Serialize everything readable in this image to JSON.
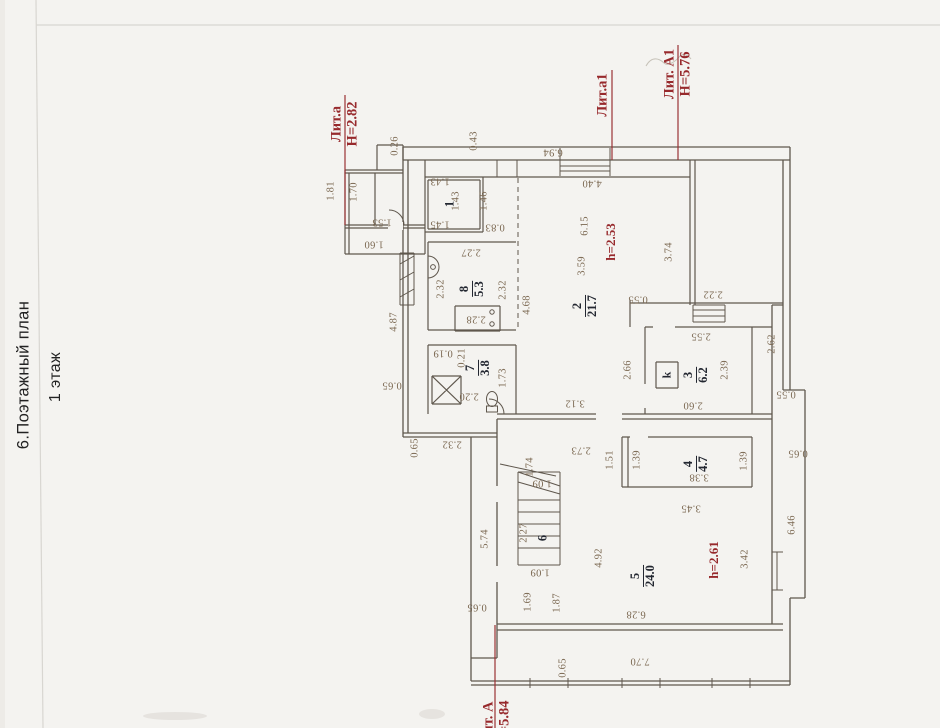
{
  "header": {
    "title": "6.Поэтажный план",
    "floor": "1 этаж"
  },
  "plan": {
    "colors": {
      "wall": "#5f574d",
      "dim": "#7a6750",
      "room": "#232731",
      "red": "#97292c"
    },
    "lit_labels": [
      {
        "lines": [
          "Лит.а",
          "Н=2.82"
        ],
        "x": 345,
        "y": 124
      },
      {
        "lines": [
          "Лит.а1"
        ],
        "x": 603,
        "y": 95
      },
      {
        "lines": [
          "Лит. А1",
          "Н=5.76"
        ],
        "x": 678,
        "y": 74
      },
      {
        "lines": [
          "Лит. А",
          "Н=5.84"
        ],
        "x": 497,
        "y": 723
      }
    ],
    "height_labels": [
      {
        "t": "h=2.53",
        "x": 611,
        "y": 242
      },
      {
        "t": "h=2.61",
        "x": 714,
        "y": 560
      }
    ],
    "stove": {
      "label": "k",
      "x": 667,
      "y": 375
    },
    "rooms": [
      {
        "num": "1",
        "area": "",
        "x": 450,
        "y": 204
      },
      {
        "num": "8",
        "area": "5.3",
        "x": 472,
        "y": 289
      },
      {
        "num": "2",
        "area": "21.7",
        "x": 585,
        "y": 306
      },
      {
        "num": "7",
        "area": "3.8",
        "x": 478,
        "y": 368
      },
      {
        "num": "3",
        "area": "6.2",
        "x": 696,
        "y": 375
      },
      {
        "num": "4",
        "area": "4.7",
        "x": 696,
        "y": 464
      },
      {
        "num": "6",
        "area": "",
        "x": 543,
        "y": 538
      },
      {
        "num": "5",
        "area": "24.0",
        "x": 643,
        "y": 576
      }
    ],
    "dims": [
      {
        "t": "0.26",
        "x": 395,
        "y": 146,
        "o": "v"
      },
      {
        "t": "0.43",
        "x": 474,
        "y": 141,
        "o": "v"
      },
      {
        "t": "6.94",
        "x": 553,
        "y": 152,
        "o": "u"
      },
      {
        "t": "4.40",
        "x": 592,
        "y": 183,
        "o": "u"
      },
      {
        "t": "1.81",
        "x": 331,
        "y": 191,
        "o": "v"
      },
      {
        "t": "1.70",
        "x": 354,
        "y": 192,
        "o": "v"
      },
      {
        "t": "1.53",
        "x": 382,
        "y": 222,
        "o": "u"
      },
      {
        "t": "1.60",
        "x": 374,
        "y": 244,
        "o": "u"
      },
      {
        "t": "1.43",
        "x": 440,
        "y": 181,
        "o": "u"
      },
      {
        "t": "1.43",
        "x": 456,
        "y": 201,
        "o": "v"
      },
      {
        "t": "1.45",
        "x": 440,
        "y": 224,
        "o": "u"
      },
      {
        "t": "1.46",
        "x": 484,
        "y": 201,
        "o": "v"
      },
      {
        "t": "0.83",
        "x": 495,
        "y": 227,
        "o": "u"
      },
      {
        "t": "2.27",
        "x": 471,
        "y": 252,
        "o": "u"
      },
      {
        "t": "2.32",
        "x": 441,
        "y": 289,
        "o": "v"
      },
      {
        "t": "2.32",
        "x": 503,
        "y": 290,
        "o": "v"
      },
      {
        "t": "4.68",
        "x": 527,
        "y": 305,
        "o": "v"
      },
      {
        "t": "4.87",
        "x": 394,
        "y": 322,
        "o": "v"
      },
      {
        "t": "6.15",
        "x": 585,
        "y": 226,
        "o": "v"
      },
      {
        "t": "3.59",
        "x": 582,
        "y": 266,
        "o": "v"
      },
      {
        "t": "3.74",
        "x": 669,
        "y": 252,
        "o": "v"
      },
      {
        "t": "0.55",
        "x": 638,
        "y": 299,
        "o": "u"
      },
      {
        "t": "2.22",
        "x": 713,
        "y": 294,
        "o": "u"
      },
      {
        "t": "2.55",
        "x": 701,
        "y": 336,
        "o": "u"
      },
      {
        "t": "2.62",
        "x": 772,
        "y": 344,
        "o": "v"
      },
      {
        "t": "2.66",
        "x": 628,
        "y": 370,
        "o": "v"
      },
      {
        "t": "2.39",
        "x": 725,
        "y": 370,
        "o": "v"
      },
      {
        "t": "0.55",
        "x": 786,
        "y": 394,
        "o": "u"
      },
      {
        "t": "2.60",
        "x": 693,
        "y": 405,
        "o": "u"
      },
      {
        "t": "3.12",
        "x": 575,
        "y": 403,
        "o": "u"
      },
      {
        "t": "2.73",
        "x": 581,
        "y": 450,
        "o": "u"
      },
      {
        "t": "1.51",
        "x": 610,
        "y": 460,
        "o": "v"
      },
      {
        "t": "1.39",
        "x": 637,
        "y": 460,
        "o": "v"
      },
      {
        "t": "1.39",
        "x": 744,
        "y": 461,
        "o": "v"
      },
      {
        "t": "3.38",
        "x": 699,
        "y": 477,
        "o": "u"
      },
      {
        "t": "0.65",
        "x": 798,
        "y": 453,
        "o": "u"
      },
      {
        "t": "6.46",
        "x": 792,
        "y": 525,
        "o": "v"
      },
      {
        "t": "3.42",
        "x": 745,
        "y": 559,
        "o": "v"
      },
      {
        "t": "3.45",
        "x": 691,
        "y": 508,
        "o": "u"
      },
      {
        "t": "0.19",
        "x": 443,
        "y": 353,
        "o": "u"
      },
      {
        "t": "0.21",
        "x": 462,
        "y": 358,
        "o": "v"
      },
      {
        "t": "1.73",
        "x": 503,
        "y": 378,
        "o": "v"
      },
      {
        "t": "2.20",
        "x": 469,
        "y": 396,
        "o": "u"
      },
      {
        "t": "2.28",
        "x": 476,
        "y": 319,
        "o": "u"
      },
      {
        "t": "0.65",
        "x": 392,
        "y": 385,
        "o": "u"
      },
      {
        "t": "0.65",
        "x": 415,
        "y": 448,
        "o": "v"
      },
      {
        "t": "2.32",
        "x": 452,
        "y": 444,
        "o": "u"
      },
      {
        "t": "1.74",
        "x": 530,
        "y": 467,
        "o": "v"
      },
      {
        "t": "1.09",
        "x": 542,
        "y": 483,
        "o": "u"
      },
      {
        "t": "2.27",
        "x": 524,
        "y": 533,
        "o": "v"
      },
      {
        "t": "1.09",
        "x": 540,
        "y": 572,
        "o": "u"
      },
      {
        "t": "5.74",
        "x": 485,
        "y": 539,
        "o": "v"
      },
      {
        "t": "4.92",
        "x": 599,
        "y": 558,
        "o": "v"
      },
      {
        "t": "6.28",
        "x": 636,
        "y": 614,
        "o": "u"
      },
      {
        "t": "7.70",
        "x": 640,
        "y": 661,
        "o": "u"
      },
      {
        "t": "0.65",
        "x": 563,
        "y": 668,
        "o": "v"
      },
      {
        "t": "0.65",
        "x": 477,
        "y": 607,
        "o": "u"
      },
      {
        "t": "1.69",
        "x": 528,
        "y": 602,
        "o": "v"
      },
      {
        "t": "1.87",
        "x": 557,
        "y": 603,
        "o": "v"
      }
    ]
  }
}
